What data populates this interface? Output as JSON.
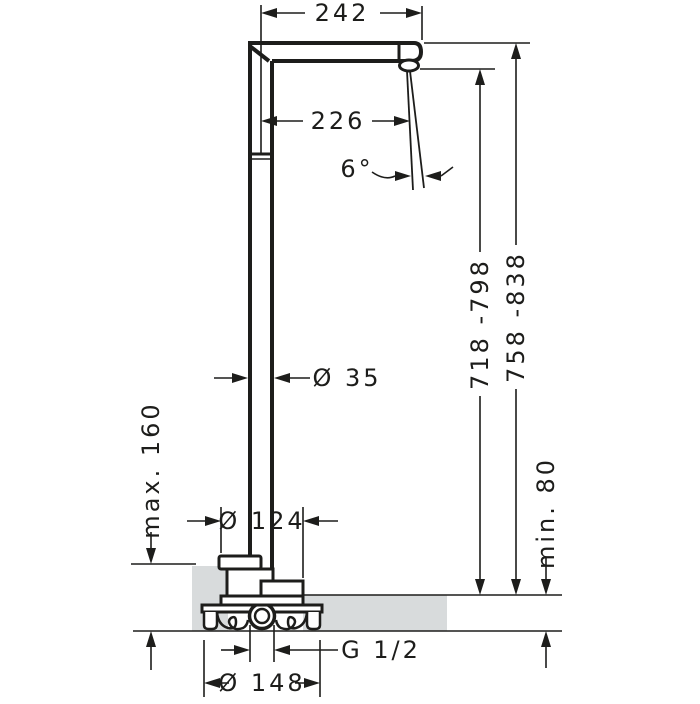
{
  "drawing": {
    "colors": {
      "line": "#1d1d1b",
      "floor_fill": "#d8dbdc",
      "background": "#ffffff"
    },
    "labels": {
      "reach_total": "242",
      "reach_to_outlet": "226",
      "spray_angle": "6°",
      "pipe_diameter": "Ø 35",
      "outlet_height": "718 -798",
      "total_height": "758 -838",
      "max_floor": "max. 160",
      "min_floor": "min. 80",
      "escutcheon_diameter": "Ø 124",
      "connection": "G 1/2",
      "flange_diameter": "Ø 148"
    }
  }
}
